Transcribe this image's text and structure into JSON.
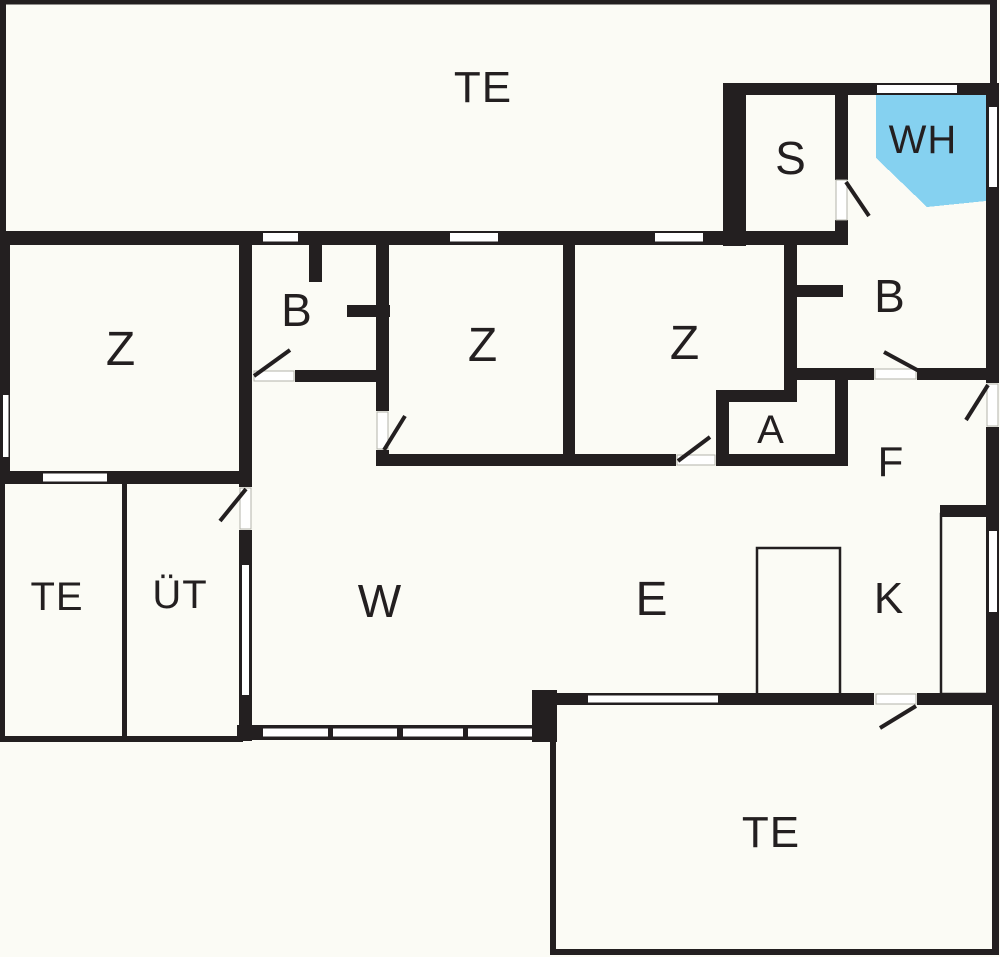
{
  "colors": {
    "wall": "#231f20",
    "window_fill": "#ffffff",
    "whirlpool_fill": "#85d1f0",
    "label": "#231f20"
  },
  "rooms": [
    {
      "id": "terrace-top",
      "label": "TE"
    },
    {
      "id": "sauna",
      "label": "S"
    },
    {
      "id": "whirlpool",
      "label": "WH"
    },
    {
      "id": "bedroom-left",
      "label": "Z"
    },
    {
      "id": "bathroom-left",
      "label": "B"
    },
    {
      "id": "bedroom-middle",
      "label": "Z"
    },
    {
      "id": "bedroom-right",
      "label": "Z"
    },
    {
      "id": "bathroom-right",
      "label": "B"
    },
    {
      "id": "storage",
      "label": "A"
    },
    {
      "id": "hallway",
      "label": "F"
    },
    {
      "id": "terrace-left",
      "label": "TE"
    },
    {
      "id": "covered-terrace",
      "label": "ÜT"
    },
    {
      "id": "living-room",
      "label": "W"
    },
    {
      "id": "dining-room",
      "label": "E"
    },
    {
      "id": "kitchen",
      "label": "K"
    },
    {
      "id": "terrace-bottom",
      "label": "TE"
    }
  ]
}
